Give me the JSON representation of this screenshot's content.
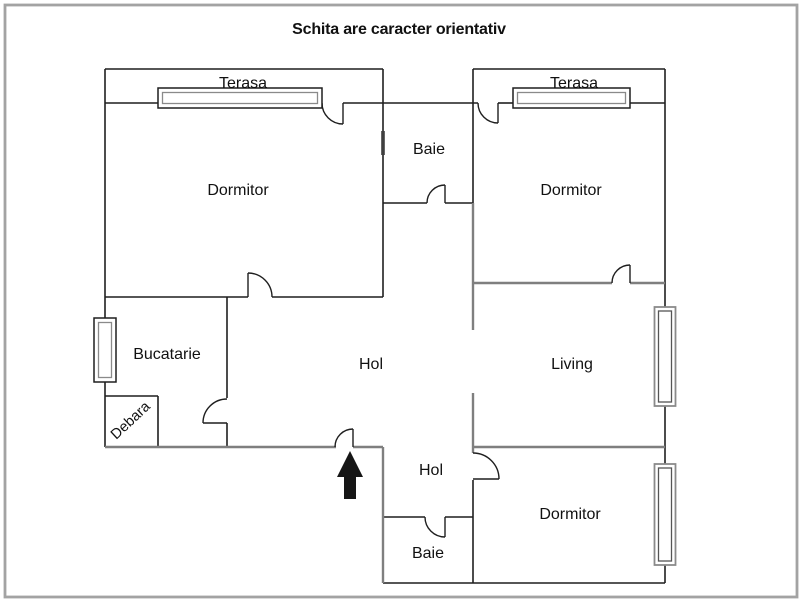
{
  "title": "Schita are caracter orientativ",
  "colors": {
    "background": "#ffffff",
    "wall": "#1f1f1f",
    "gray_wall": "#7f7f7f",
    "border": "#a3a3a3",
    "arrow": "#161616",
    "label": "#111111"
  },
  "rooms": {
    "terasa_left": {
      "label": "Terasa"
    },
    "terasa_right": {
      "label": "Terasa"
    },
    "dormitor_left": {
      "label": "Dormitor"
    },
    "dormitor_right_top": {
      "label": "Dormitor"
    },
    "dormitor_right_bottom": {
      "label": "Dormitor"
    },
    "baie_top": {
      "label": "Baie"
    },
    "baie_bottom": {
      "label": "Baie"
    },
    "bucatarie": {
      "label": "Bucatarie"
    },
    "debara": {
      "label": "Debara"
    },
    "hol_center": {
      "label": "Hol"
    },
    "hol_bottom": {
      "label": "Hol"
    },
    "living": {
      "label": "Living"
    }
  }
}
